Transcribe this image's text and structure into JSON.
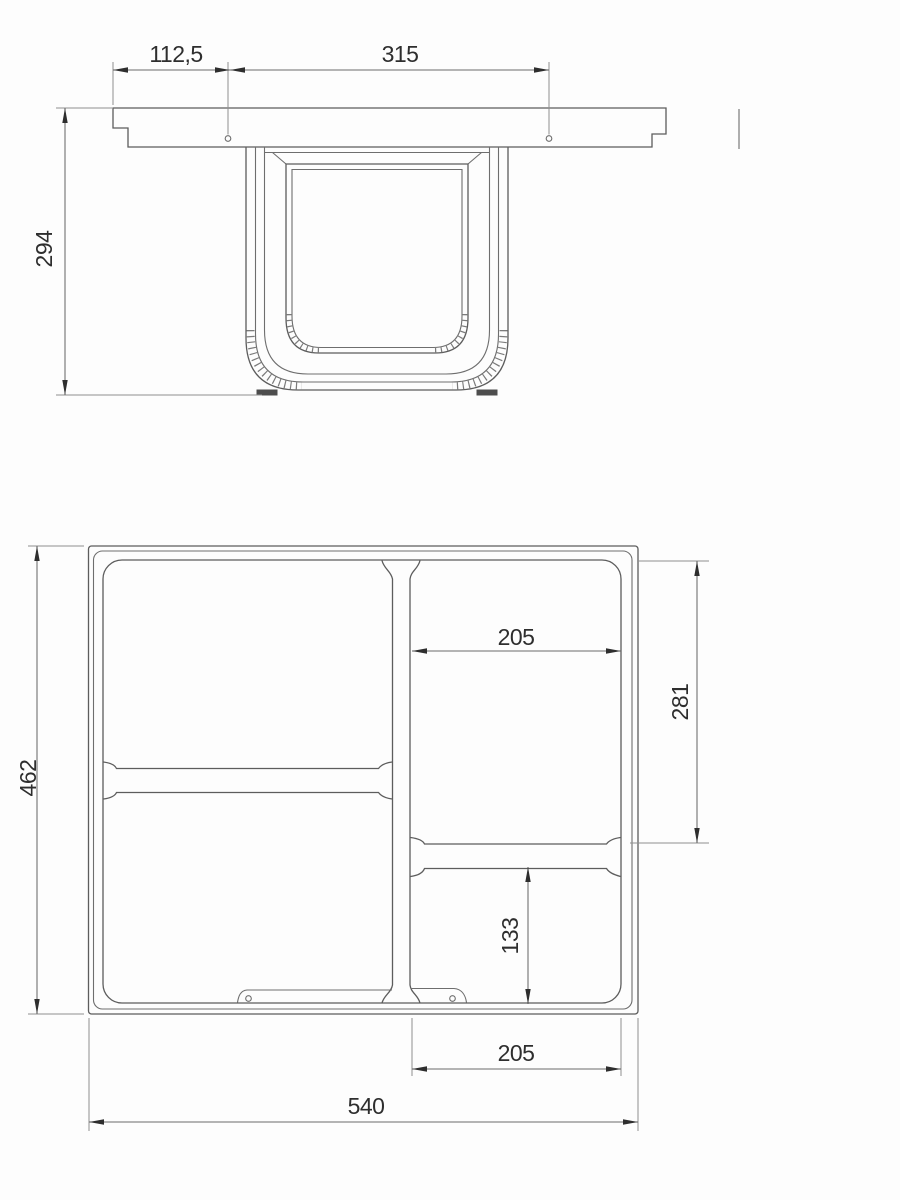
{
  "colors": {
    "background": "#fdfdfd",
    "geometry_line": "#5d5d5d",
    "thin_line": "#8f8f8f",
    "dimension_ink": "#2e2e2e"
  },
  "front_view": {
    "dim_hole_edge_offset": "112,5",
    "dim_hole_spacing": "315",
    "dim_frame_height": "294"
  },
  "plan_view": {
    "dim_right_bay_width_top": "205",
    "dim_right_bay_depth": "281",
    "dim_lower_bay_depth": "133",
    "dim_right_bay_width_bottom": "205",
    "dim_overall_width": "540",
    "dim_overall_depth": "462"
  }
}
